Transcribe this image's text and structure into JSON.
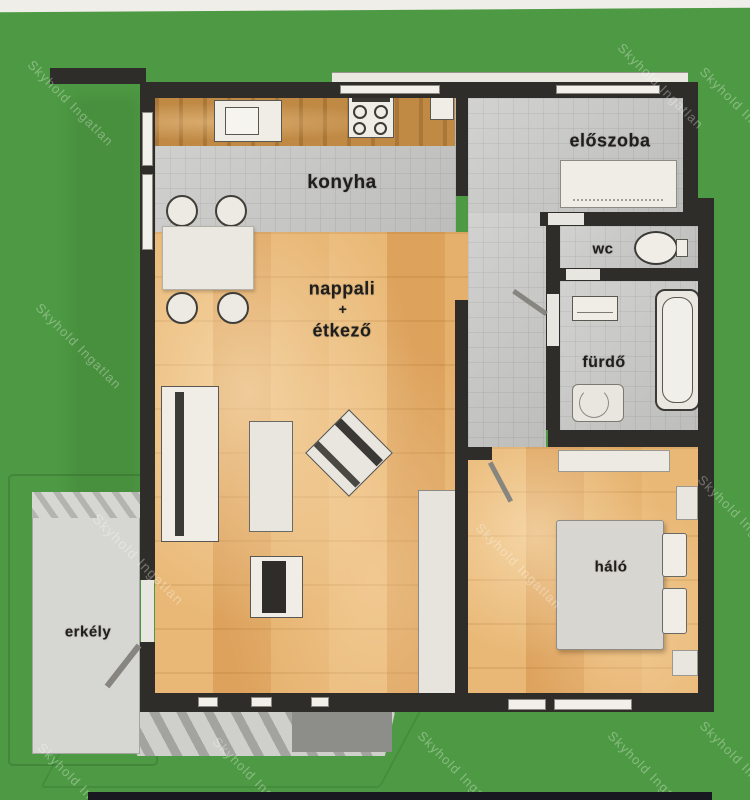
{
  "meta": {
    "type": "apartment floor plan (scanned)",
    "language": "hu"
  },
  "colors": {
    "background": "#4e9a44",
    "wall": "#2e2d29",
    "tile": "#c9c9c7",
    "wood": "#e4ad68",
    "counter": "#c08a45",
    "furniture": "#efede6",
    "bed": "#d8d6d0",
    "balcony": "#d6d6d2",
    "label": "#1f1e1c",
    "watermark": "#ffffff",
    "top_strip": "#efeee8",
    "bottom_strip": "#181820"
  },
  "rooms": {
    "kitchen": {
      "label": "konyha"
    },
    "hall": {
      "label": "előszoba"
    },
    "wc": {
      "label": "wc"
    },
    "bathroom": {
      "label": "fürdő"
    },
    "living_dining": {
      "line1": "nappali",
      "line2": "+",
      "line3": "étkező"
    },
    "bedroom": {
      "label": "háló"
    },
    "balcony": {
      "label": "erkély"
    }
  },
  "watermarks": [
    {
      "text": "Skyhold Ingatlan",
      "x": 30,
      "y": 55,
      "rot": 45,
      "size": 13
    },
    {
      "text": "Skyhold Ingatlan",
      "x": 620,
      "y": 38,
      "rot": 45,
      "size": 13
    },
    {
      "text": "Skyhold Ingatlan",
      "x": 702,
      "y": 62,
      "rot": 45,
      "size": 13
    },
    {
      "text": "Skyhold Ingatlan",
      "x": 38,
      "y": 298,
      "rot": 45,
      "size": 13
    },
    {
      "text": "Skyhold Ingatlan",
      "x": 95,
      "y": 508,
      "rot": 45,
      "size": 14
    },
    {
      "text": "Skyhold Ingatlan",
      "x": 478,
      "y": 518,
      "rot": 45,
      "size": 13
    },
    {
      "text": "Skyhold Ingatlan",
      "x": 700,
      "y": 470,
      "rot": 45,
      "size": 13
    },
    {
      "text": "Skyhold Ingatlan",
      "x": 40,
      "y": 738,
      "rot": 45,
      "size": 13
    },
    {
      "text": "Skyhold Ingatlan",
      "x": 215,
      "y": 732,
      "rot": 45,
      "size": 13
    },
    {
      "text": "Skyhold Ingatlan",
      "x": 420,
      "y": 726,
      "rot": 45,
      "size": 13
    },
    {
      "text": "Skyhold Ingatlan",
      "x": 610,
      "y": 726,
      "rot": 45,
      "size": 13
    },
    {
      "text": "Skyhold Ingatlan",
      "x": 702,
      "y": 716,
      "rot": 45,
      "size": 13
    }
  ]
}
